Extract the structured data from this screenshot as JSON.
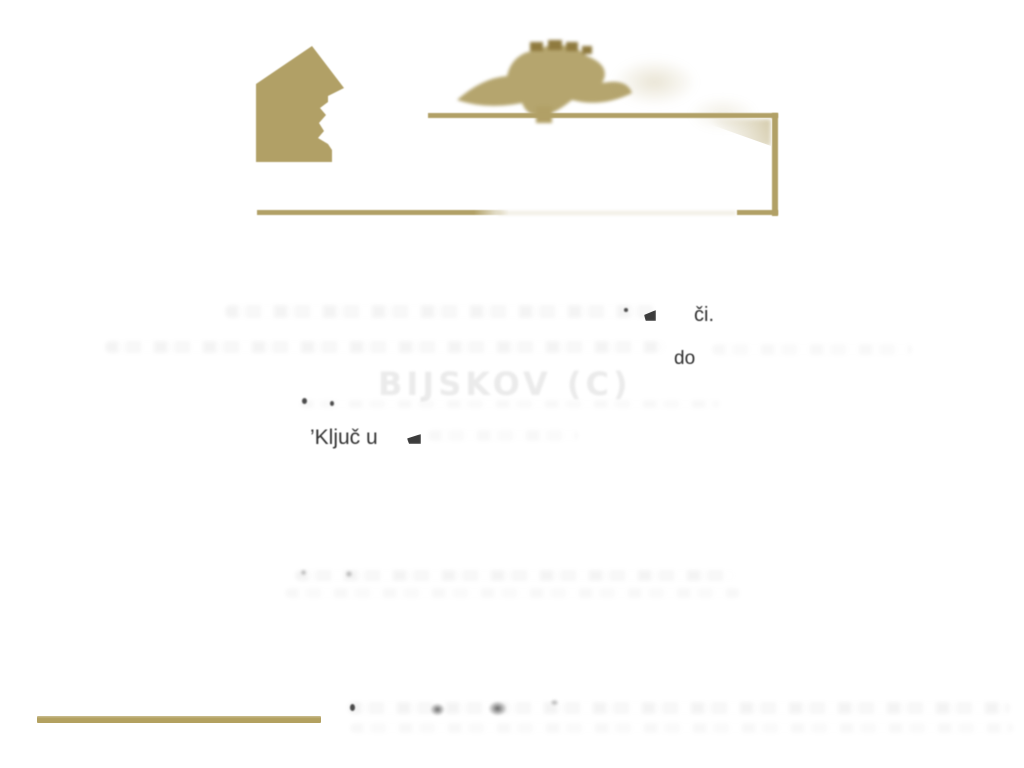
{
  "colors": {
    "gold": "#b1a066",
    "gold_dark": "#8f7a3e",
    "ink": "#2e2e2e",
    "ghost_gray": "#ebebeb"
  },
  "logo": {
    "house_icon": "house-silhouette",
    "ornament_icon": "laurel-ornament",
    "frame_icon": "open-rectangular-frame"
  },
  "fragments": {
    "line1_suffix": "či.",
    "line2_word": "do",
    "ghost_title": "BIJSKOV (C)",
    "kljuc_phrase": "’Ključ u"
  }
}
